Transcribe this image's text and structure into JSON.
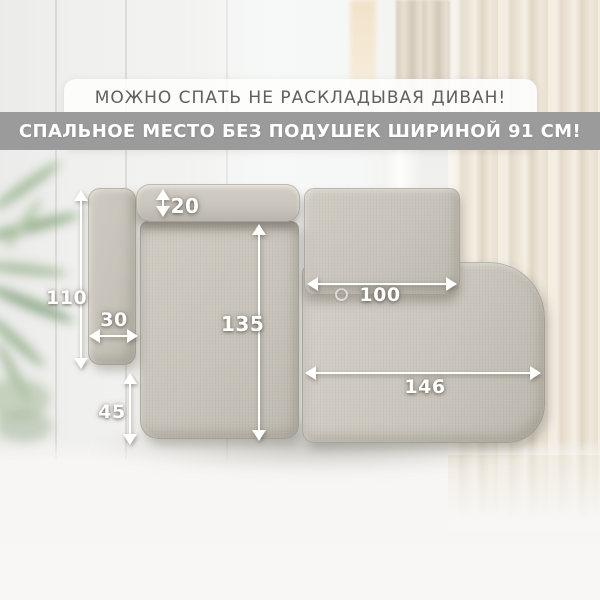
{
  "header": {
    "headline": "МОЖНО СПАТЬ НЕ РАСКЛАДЫВАЯ ДИВАН!",
    "banner": "СПАЛЬНОЕ МЕСТО БЕЗ ПОДУШЕК ШИРИНОЙ 91 СМ!"
  },
  "diagram": {
    "type": "sofa-top-view-with-dimensions",
    "dimensions": {
      "bolster_depth": "20",
      "left_side_length": "110",
      "armrest_width": "30",
      "seat_depth": "135",
      "front_seat_depth": "45",
      "backrest_section_width": "100",
      "chaise_section_width": "146"
    }
  },
  "colors": {
    "banner_bg": "#9b9b9b",
    "headline_text": "#5f5f5f",
    "banner_text": "#ffffff",
    "sofa_fabric": "#c9c5bc",
    "arrow": "#ffffff",
    "curtain": "#ece4d6",
    "wall": "#f1f0ee",
    "floor": "#f7f6f4",
    "plant_green": "#9cb394"
  }
}
